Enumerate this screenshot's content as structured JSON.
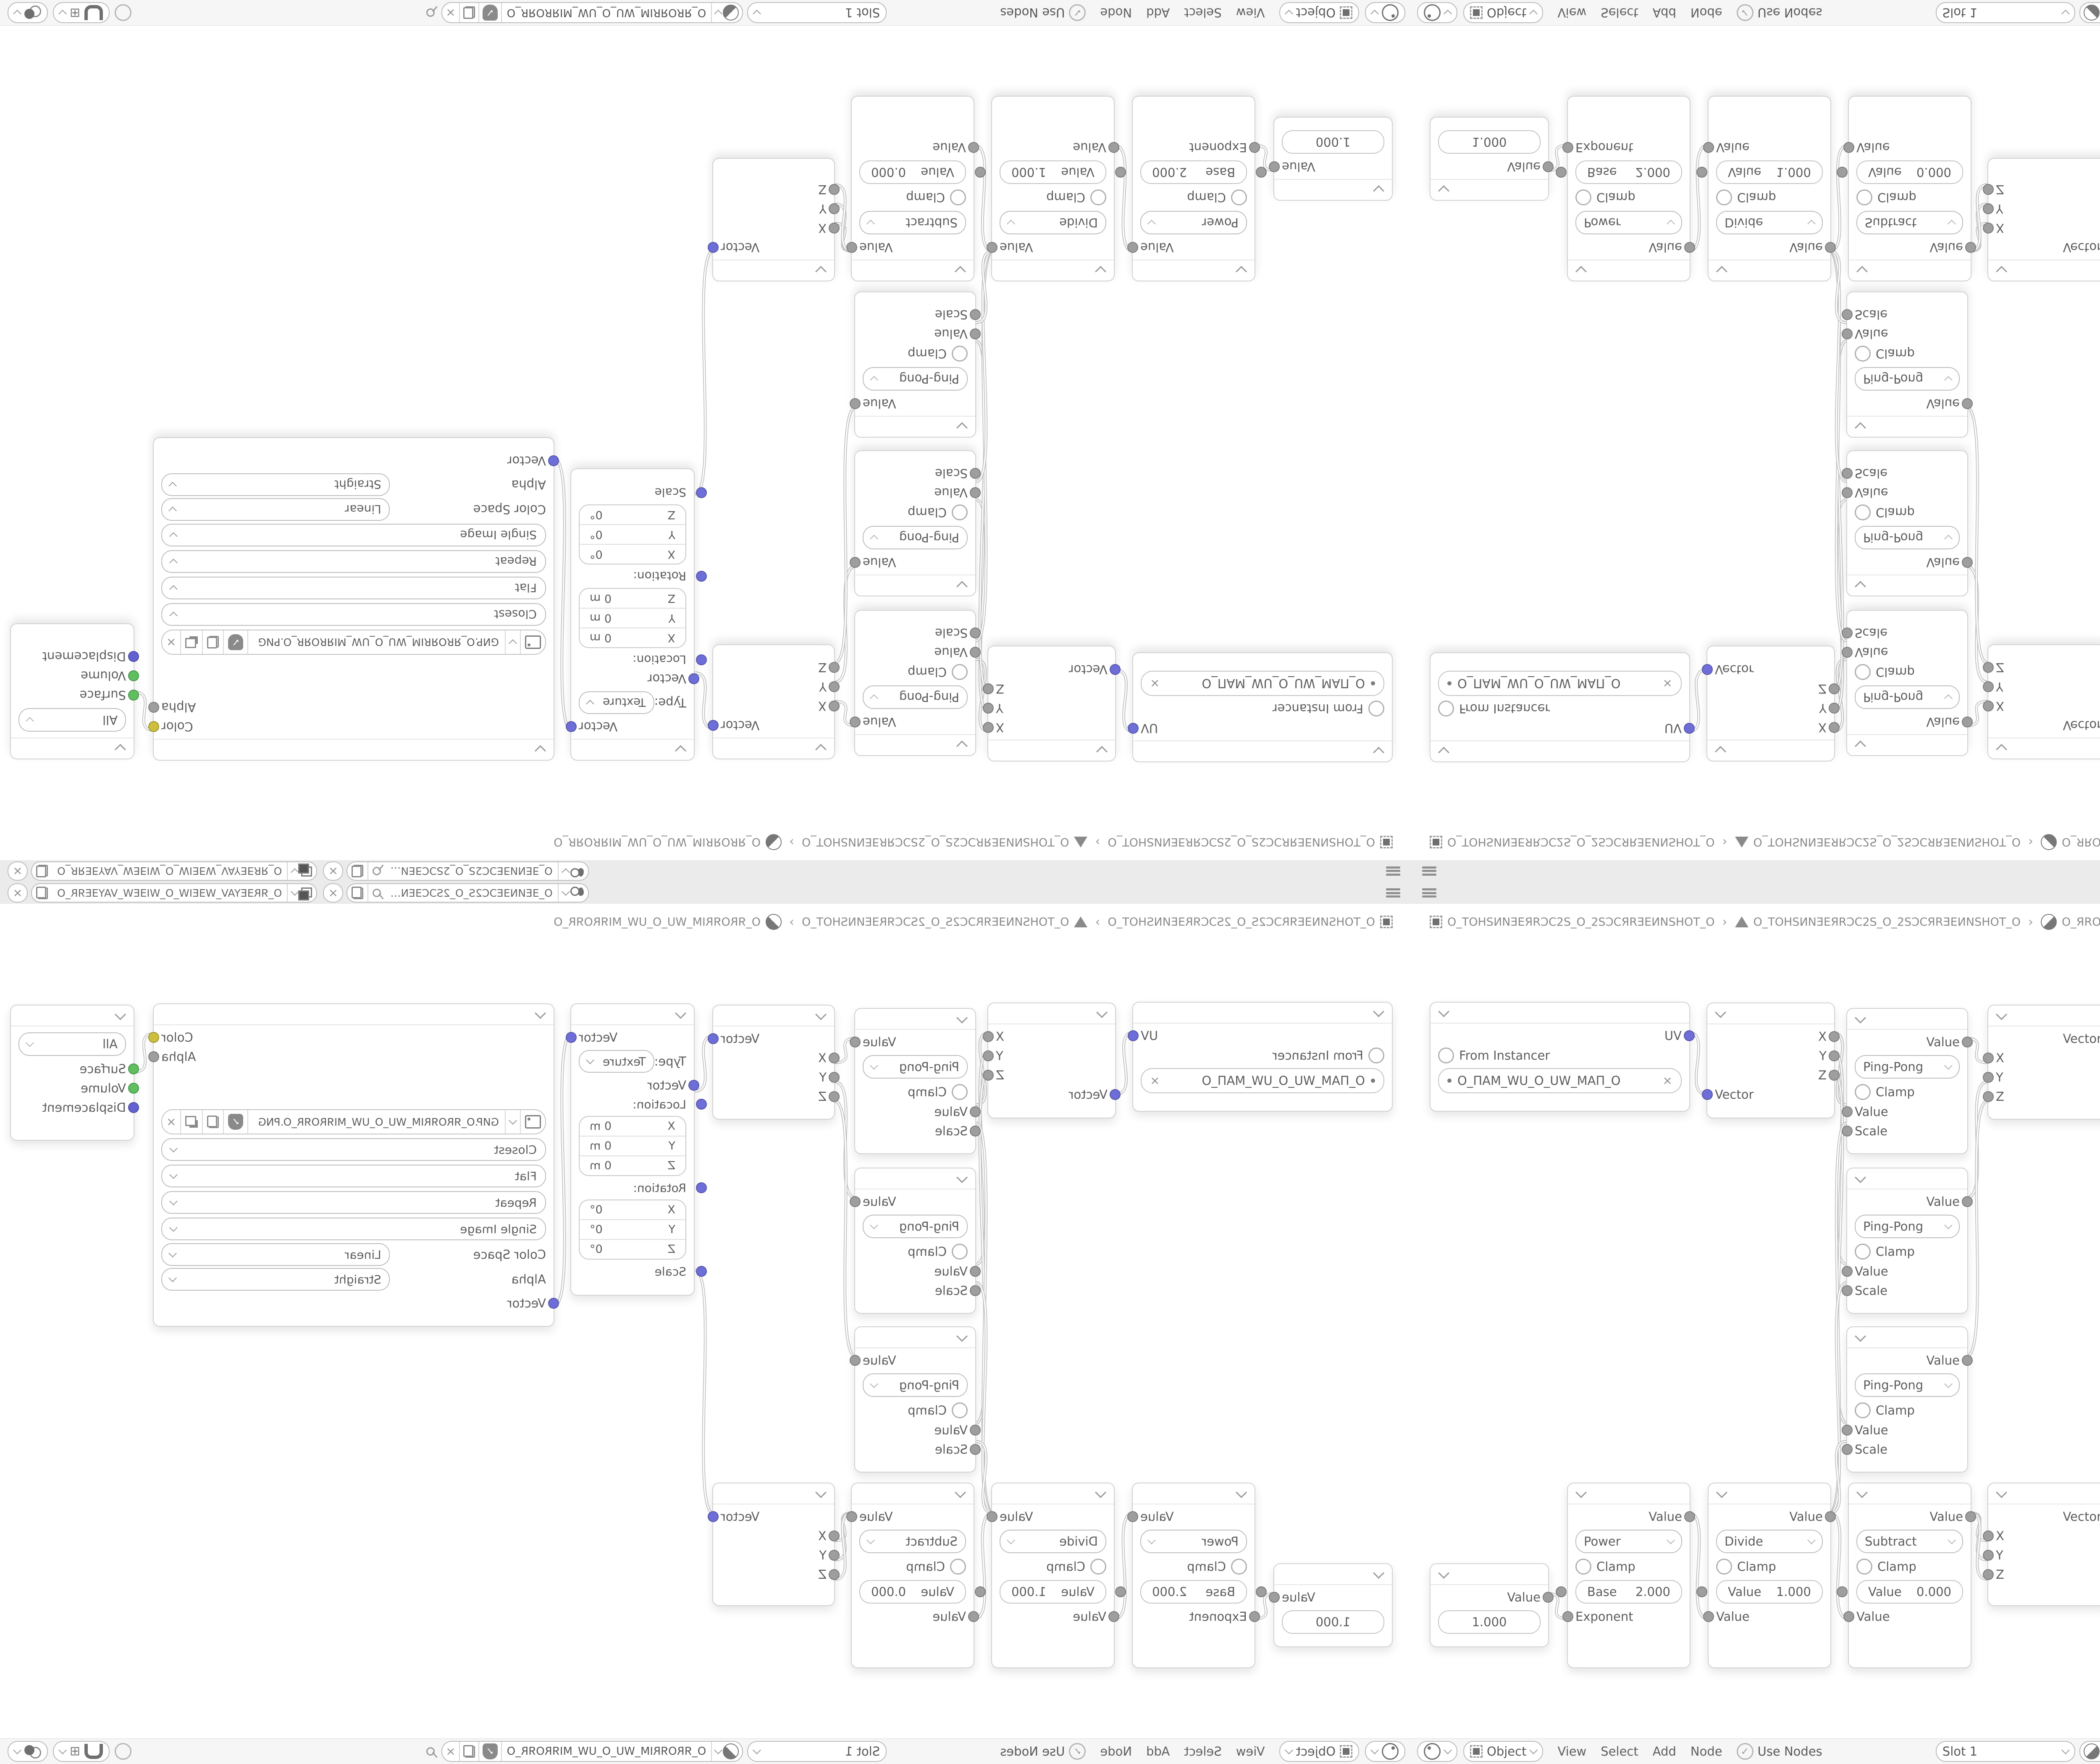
{
  "colors": {
    "canvas": "#ffffff",
    "topbar": "#ebebeb",
    "header_bar": "#f6f6f6",
    "node_border": "#d2d2d2",
    "socket_vector": "#6e6ed8",
    "socket_value": "#9e9e9e",
    "socket_color": "#cdbf3e",
    "socket_shader": "#5fbf5f",
    "socket_displacement": "#6161d1",
    "link": "#c6c6c6",
    "text": "#5d5d5d"
  },
  "topbar": {
    "scene": {
      "name": "O_ƎEͶNƎEƆC2S_O_2SƆCƎEN…"
    },
    "view_layer": {
      "name": "O_ЯRƎEYAV_WƎEIW_O_WIƎEW_VAYƎEЯR_O"
    }
  },
  "context_path": {
    "object": "O_TOHSͶNƎEЯRƆC2S_O_2SƆCЯRƎEͶNSHOT_O",
    "mesh": "O_TOHSͶNƎEЯRƆC2S_O_2SƆCЯRƎEͶNSHOT_O",
    "material": "O_ЯROЯRIM_WU_O_UW_MIЯROЯR_O",
    "sep": "›"
  },
  "header": {
    "shader_type": "Object",
    "menus": [
      "View",
      "Select",
      "Add",
      "Node"
    ],
    "use_nodes": "Use Nodes",
    "slot": "Slot 1",
    "material_name": "O_ЯROЯRIM_WU_O_UW_MIЯROЯR_O"
  },
  "nodes": {
    "uv_map": {
      "out": "UV",
      "from_instancer": "From Instancer",
      "name": "O_ПAM_WU_O_UW_MAП_O",
      "clear": "×"
    },
    "separate": {
      "x": "X",
      "y": "Y",
      "z": "Z",
      "in": "Vector"
    },
    "ping": {
      "out": "Value",
      "op": "Ping-Pong",
      "clamp": "Clamp",
      "value_in": "Value",
      "scale_in": "Scale"
    },
    "combine": {
      "out": "Vector",
      "x": "X",
      "y": "Y",
      "z": "Z"
    },
    "mapping": {
      "out": "Vector",
      "type_label": "Type:",
      "type": "Texture",
      "vector_in": "Vector",
      "location_label": "Location:",
      "rotation_label": "Rotation:",
      "scale_label": "Scale",
      "ax": "X",
      "ay": "Y",
      "az": "Z",
      "loc_value": "0 m",
      "rot_value": "0°"
    },
    "image": {
      "color_out": "Color",
      "alpha_out": "Alpha",
      "filename": "GИP.O_ЯROЯRIM_WU_O_UW_MIЯROЯR_O.PNG",
      "interpolation": "Closest",
      "projection": "Flat",
      "extension": "Repeat",
      "source": "Single Image",
      "color_space_label": "Color Space",
      "color_space": "Linear",
      "alpha_label": "Alpha",
      "alpha": "Straight",
      "vector_in": "Vector"
    },
    "output": {
      "target": "All",
      "surface": "Surface",
      "volume": "Volume",
      "displacement": "Displacement"
    },
    "value": {
      "out": "Value",
      "value": "1.000"
    },
    "power": {
      "out": "Value",
      "op": "Power",
      "clamp": "Clamp",
      "field_label": "Base",
      "field_value": "2.000",
      "in2": "Exponent"
    },
    "divide": {
      "out": "Value",
      "op": "Divide",
      "clamp": "Clamp",
      "field_label": "Value",
      "field_value": "1.000",
      "in2": "Value"
    },
    "subtract": {
      "out": "Value",
      "op": "Subtract",
      "clamp": "Clamp",
      "field_label": "Value",
      "field_value": "0.000",
      "in2": "Value"
    }
  }
}
